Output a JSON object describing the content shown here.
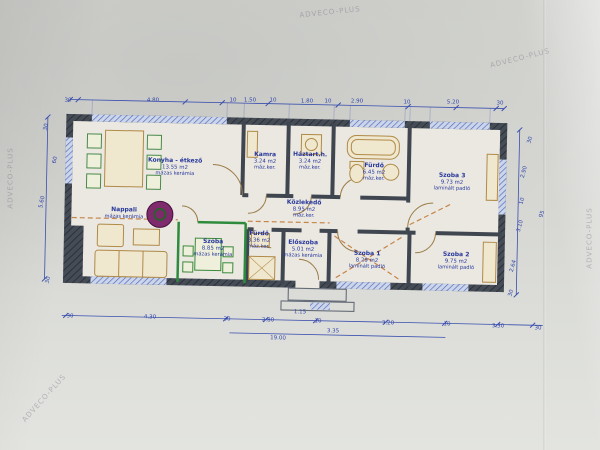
{
  "document": {
    "kind": "scanned architectural floor plan photograph",
    "unit": "m",
    "total_length_label": "19.00"
  },
  "watermark": {
    "text": "ADVECO-PLUS"
  },
  "watermark_positions": [
    {
      "x": 330,
      "y": 12,
      "r": -6
    },
    {
      "x": 520,
      "y": 58,
      "r": -14
    },
    {
      "x": 10,
      "y": 178,
      "r": -90
    },
    {
      "x": 44,
      "y": 398,
      "r": -48
    },
    {
      "x": 589,
      "y": 238,
      "r": -90
    }
  ],
  "rooms": [
    {
      "name": "Konyha - étkező",
      "area": "13.55 m2",
      "floor": "mázas kerámia",
      "x": 175,
      "y": 167
    },
    {
      "name": "Kamra",
      "area": "3.24 m2",
      "floor": "máz.ker.",
      "x": 265,
      "y": 161
    },
    {
      "name": "Háztart.h.",
      "area": "3.24 m2",
      "floor": "máz.ker.",
      "x": 310,
      "y": 161
    },
    {
      "name": "Fürdő",
      "area": "6.45 m2",
      "floor": "máz.ker.",
      "x": 374,
      "y": 172
    },
    {
      "name": "Szoba 3",
      "area": "9.73 m2",
      "floor": "laminált padló",
      "x": 452,
      "y": 182
    },
    {
      "name": "Közlekedő",
      "area": "8.95 m2",
      "floor": "máz.ker.",
      "x": 304,
      "y": 209
    },
    {
      "name": "Nappali",
      "area": "",
      "floor": "mázas kerámia",
      "x": 124,
      "y": 213
    },
    {
      "name": "Szoba",
      "area": "8.85 m2",
      "floor": "mázas kerámia",
      "x": 213,
      "y": 248
    },
    {
      "name": "Fürdő",
      "area": "3.36 m2",
      "floor": "máz.ker.",
      "x": 259,
      "y": 240
    },
    {
      "name": "Előszoba",
      "area": "5.01 m2",
      "floor": "mázas kerámia",
      "x": 303,
      "y": 249
    },
    {
      "name": "Szoba 1",
      "area": "8.29 m2",
      "floor": "laminált padló",
      "x": 367,
      "y": 260
    },
    {
      "name": "Szoba 2",
      "area": "9.75 m2",
      "floor": "laminált padló",
      "x": 456,
      "y": 261
    }
  ],
  "dimensions": {
    "top": [
      {
        "t": "30",
        "x": 68,
        "y": 100,
        "r": 0
      },
      {
        "t": "4.80",
        "x": 153,
        "y": 100,
        "r": 0
      },
      {
        "t": "10",
        "x": 233,
        "y": 100,
        "r": 0
      },
      {
        "t": "1.50",
        "x": 250,
        "y": 100,
        "r": 0
      },
      {
        "t": "10",
        "x": 273,
        "y": 100,
        "r": 0
      },
      {
        "t": "1.80",
        "x": 307,
        "y": 101,
        "r": 0
      },
      {
        "t": "10",
        "x": 328,
        "y": 101,
        "r": 0
      },
      {
        "t": "2.90",
        "x": 357,
        "y": 101,
        "r": 0
      },
      {
        "t": "10",
        "x": 407,
        "y": 102,
        "r": 0
      },
      {
        "t": "5.20",
        "x": 453,
        "y": 102,
        "r": 0
      },
      {
        "t": "30",
        "x": 500,
        "y": 103,
        "r": 0
      }
    ],
    "bottom": [
      {
        "t": "30",
        "x": 70,
        "y": 316,
        "r": 1
      },
      {
        "t": "4.30",
        "x": 150,
        "y": 317,
        "r": 1
      },
      {
        "t": "30",
        "x": 227,
        "y": 319,
        "r": 1
      },
      {
        "t": "2.80",
        "x": 268,
        "y": 320,
        "r": 1
      },
      {
        "t": "10",
        "x": 318,
        "y": 321,
        "r": 1
      },
      {
        "t": "3.20",
        "x": 388,
        "y": 323,
        "r": 1
      },
      {
        "t": "10",
        "x": 447,
        "y": 324,
        "r": 1
      },
      {
        "t": "3.30",
        "x": 498,
        "y": 326,
        "r": 1
      },
      {
        "t": "30",
        "x": 538,
        "y": 328,
        "r": 1
      }
    ],
    "totals": [
      {
        "t": "1.15",
        "x": 300,
        "y": 312,
        "r": 1
      },
      {
        "t": "3.35",
        "x": 333,
        "y": 331,
        "r": 1
      },
      {
        "t": "19.00",
        "x": 278,
        "y": 338,
        "r": 1
      }
    ],
    "left": [
      {
        "t": "30",
        "x": 46,
        "y": 127,
        "r": -78
      },
      {
        "t": "60",
        "x": 55,
        "y": 160,
        "r": -78
      },
      {
        "t": "5.60",
        "x": 42,
        "y": 202,
        "r": -78
      },
      {
        "t": "30",
        "x": 48,
        "y": 280,
        "r": -78
      }
    ],
    "right": [
      {
        "t": "30",
        "x": 530,
        "y": 140,
        "r": -75
      },
      {
        "t": "2.90",
        "x": 524,
        "y": 172,
        "r": -75
      },
      {
        "t": "10",
        "x": 522,
        "y": 201,
        "r": -75
      },
      {
        "t": "3.10",
        "x": 520,
        "y": 226,
        "r": -75
      },
      {
        "t": "95",
        "x": 542,
        "y": 214,
        "r": -75
      },
      {
        "t": "2.64",
        "x": 513,
        "y": 266,
        "r": -75
      },
      {
        "t": "30",
        "x": 511,
        "y": 293,
        "r": -75
      }
    ]
  },
  "colors": {
    "paper": "#d8d9d5",
    "wall_dark": "#3f4650",
    "dimension_blue": "#3246a8",
    "label_blue": "#27379b",
    "furniture_tan": "#b08a48",
    "new_wall_green": "#2e8b3d",
    "marker_orange": "#c1742f",
    "round_table_purple": "#7e2a6d",
    "window_blue": "#4d68b8"
  }
}
